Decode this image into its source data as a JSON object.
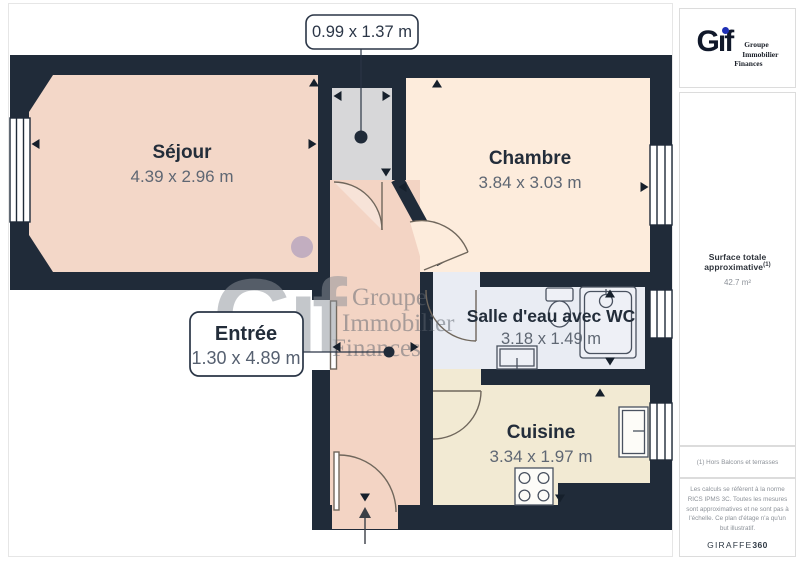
{
  "plan": {
    "callout_top": "0.99 x 1.37 m",
    "rooms": {
      "sejour": {
        "name": "Séjour",
        "dims": "4.39 x 2.96 m"
      },
      "chambre": {
        "name": "Chambre",
        "dims": "3.84 x 3.03 m"
      },
      "salle_eau": {
        "name": "Salle d'eau avec WC",
        "dims": "3.18 x 1.49 m"
      },
      "cuisine": {
        "name": "Cuisine",
        "dims": "3.34 x 1.97 m"
      },
      "entree": {
        "name": "Entrée",
        "dims": "1.30 x 4.89 m"
      }
    },
    "colors": {
      "wall": "#202b39",
      "sejour": "#f3d7c8",
      "chambre": "#fdecdc",
      "salle_eau": "#e9ecf3",
      "cuisine": "#f2ead3",
      "entree": "#f3d4c4",
      "niche": "#d7d7d9"
    }
  },
  "watermark": {
    "letters_dotless": "Gıf",
    "dot_color": "#9186b8",
    "line1": "Groupe",
    "line2": "Immobilier",
    "line3": "Finances"
  },
  "sidebar": {
    "logo": {
      "letters_dotless": "Gıf",
      "dot_color": "#1e2fb5",
      "line1": "Groupe",
      "line2": "Immobilier",
      "line3": "Finances"
    },
    "surface_label": "Surface totale approximative",
    "surface_sup": "(1)",
    "surface_value": "42.7 m²",
    "footnote": "(1) Hors Balcons et terrasses",
    "disclaimer": "Les calculs se réfèrent à la norme RICS IPMS 3C. Toutes les mesures sont approximatives et ne sont pas à l'échelle. Ce plan d'étage n'a qu'un but illustratif.",
    "brand_name": "GIRAFFE",
    "brand_suffix": "360"
  }
}
